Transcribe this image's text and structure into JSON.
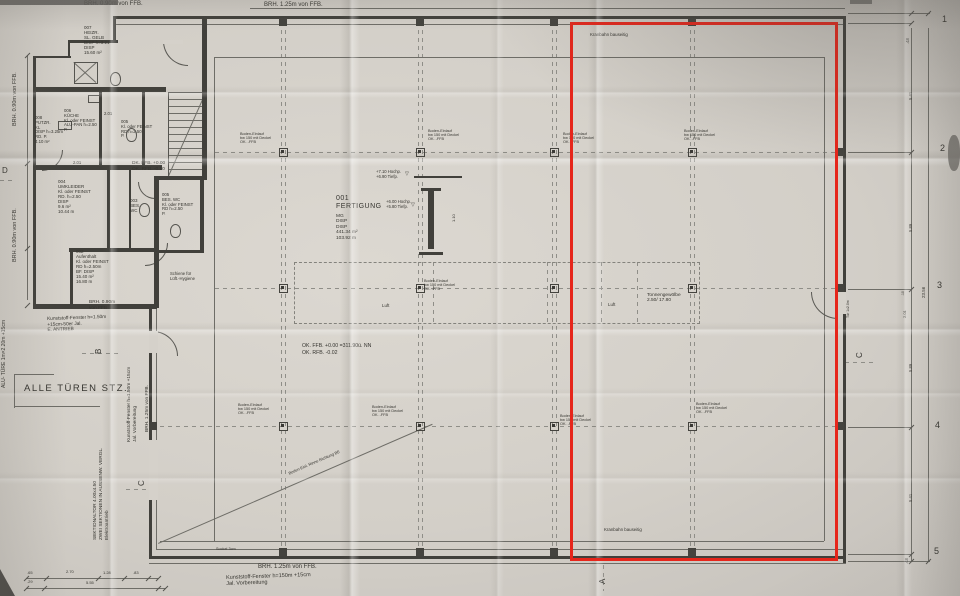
{
  "highlight": {
    "x": 570,
    "y": 22,
    "w": 268,
    "h": 539,
    "color": "#e6261b"
  },
  "plan": {
    "walls": [
      [
        113,
        16,
        733,
        3
      ],
      [
        843,
        16,
        3,
        547
      ],
      [
        149,
        556,
        697,
        3
      ],
      [
        149,
        306,
        3,
        253
      ],
      [
        113,
        16,
        3,
        27
      ],
      [
        69,
        40,
        49,
        3
      ],
      [
        33,
        56,
        3,
        252
      ],
      [
        33,
        56,
        38,
        2
      ],
      [
        68,
        40,
        2,
        18
      ],
      [
        33,
        304,
        124,
        5
      ],
      [
        36,
        87,
        130,
        5
      ],
      [
        99,
        92,
        3,
        76
      ],
      [
        142,
        92,
        3,
        76
      ],
      [
        36,
        165,
        126,
        5
      ],
      [
        202,
        18,
        5,
        162
      ],
      [
        157,
        176,
        50,
        4
      ],
      [
        154,
        176,
        5,
        76
      ],
      [
        107,
        170,
        3,
        82
      ],
      [
        129,
        170,
        2,
        82
      ],
      [
        69,
        248,
        88,
        4
      ],
      [
        70,
        248,
        3,
        60
      ],
      [
        200,
        176,
        4,
        76
      ],
      [
        157,
        250,
        47,
        3
      ],
      [
        154,
        252,
        5,
        56
      ],
      [
        414,
        176,
        48,
        2
      ],
      [
        421,
        188,
        20,
        3
      ],
      [
        428,
        191,
        6,
        58
      ],
      [
        419,
        252,
        24,
        3
      ]
    ],
    "thin": [
      [
        113,
        24,
        733,
        1
      ],
      [
        837,
        24,
        1,
        532
      ],
      [
        157,
        549,
        689,
        1
      ],
      [
        156,
        306,
        1,
        244
      ],
      [
        214,
        57,
        610,
        1
      ],
      [
        160,
        541,
        664,
        1
      ],
      [
        214,
        57,
        1,
        484
      ],
      [
        824,
        57,
        1,
        484
      ],
      [
        27,
        55,
        1,
        245
      ],
      [
        911,
        28,
        1,
        534
      ],
      [
        928,
        28,
        1,
        534
      ],
      [
        848,
        13,
        82,
        1
      ],
      [
        848,
        23,
        64,
        1
      ],
      [
        848,
        152,
        64,
        1
      ],
      [
        848,
        289,
        64,
        1
      ],
      [
        848,
        427,
        64,
        1
      ],
      [
        848,
        554,
        64,
        1
      ],
      [
        848,
        561,
        82,
        1
      ],
      [
        26,
        578,
        132,
        1
      ],
      [
        26,
        588,
        140,
        1
      ],
      [
        250,
        8,
        595,
        1
      ],
      [
        149,
        563,
        697,
        1
      ],
      [
        14,
        374,
        40,
        1
      ],
      [
        14,
        374,
        1,
        34
      ],
      [
        14,
        406,
        86,
        1
      ],
      [
        150,
        440,
        8,
        1
      ],
      [
        150,
        499,
        8,
        1
      ]
    ],
    "rot_lines": [
      [
        168,
        176,
        88,
        -66
      ],
      [
        158,
        543,
        299,
        -23.5
      ],
      [
        74,
        62,
        30,
        42
      ],
      [
        74,
        82,
        30,
        -42
      ]
    ],
    "dash_h": [
      [
        215,
        152,
        620
      ],
      [
        215,
        288,
        620
      ],
      [
        160,
        426,
        676
      ],
      [
        0,
        180,
        16
      ],
      [
        82,
        353,
        36
      ],
      [
        126,
        489,
        30
      ],
      [
        845,
        362,
        30
      ]
    ],
    "dash_v": [
      [
        281,
        30,
        516
      ],
      [
        285,
        30,
        516
      ],
      [
        418,
        30,
        516
      ],
      [
        422,
        30,
        516
      ],
      [
        552,
        30,
        516
      ],
      [
        556,
        30,
        516
      ],
      [
        690,
        30,
        516
      ],
      [
        694,
        30,
        516
      ],
      [
        433,
        262,
        60
      ],
      [
        547,
        262,
        60
      ],
      [
        601,
        262,
        60
      ],
      [
        637,
        262,
        60
      ],
      [
        603,
        565,
        26
      ]
    ],
    "zones": [
      [
        294,
        262,
        404,
        60
      ]
    ],
    "columns": [
      [
        283,
        152
      ],
      [
        420,
        152
      ],
      [
        554,
        152
      ],
      [
        692,
        152
      ],
      [
        283,
        288
      ],
      [
        420,
        288
      ],
      [
        554,
        288
      ],
      [
        692,
        288
      ],
      [
        283,
        426
      ],
      [
        420,
        426
      ],
      [
        554,
        426
      ],
      [
        692,
        426
      ]
    ],
    "pilasters": [
      [
        283,
        22
      ],
      [
        420,
        22
      ],
      [
        554,
        22
      ],
      [
        692,
        22
      ],
      [
        283,
        552
      ],
      [
        420,
        552
      ],
      [
        554,
        552
      ],
      [
        692,
        552
      ],
      [
        840,
        152
      ],
      [
        840,
        288
      ],
      [
        840,
        426
      ],
      [
        153,
        426
      ]
    ],
    "gaps": [
      [
        836,
        292,
        10,
        22
      ],
      [
        149,
        331,
        9,
        22
      ],
      [
        149,
        440,
        9,
        60
      ],
      [
        163,
        40,
        20,
        4
      ]
    ],
    "arcs": [
      [
        811,
        292,
        26,
        "bl"
      ],
      [
        153,
        331,
        24,
        "tr"
      ],
      [
        163,
        41,
        24,
        "bl"
      ],
      [
        42,
        150,
        20,
        "br"
      ],
      [
        138,
        182,
        16,
        "bl"
      ],
      [
        145,
        243,
        22,
        "br"
      ]
    ],
    "fixtures": [
      [
        110,
        72,
        9,
        12,
        "wc"
      ],
      [
        126,
        128,
        9,
        12,
        "wc"
      ],
      [
        139,
        203,
        9,
        12,
        "wc"
      ],
      [
        170,
        224,
        9,
        12,
        "wc"
      ],
      [
        58,
        121,
        12,
        7,
        "sink"
      ],
      [
        88,
        95,
        10,
        6,
        "sink"
      ],
      [
        74,
        62,
        22,
        20,
        "shower"
      ]
    ],
    "stairs": [
      168,
      92,
      35,
      84
    ],
    "ticks": [
      [
        23,
        578
      ],
      [
        43,
        578
      ],
      [
        95,
        578
      ],
      [
        121,
        578
      ],
      [
        145,
        578
      ],
      [
        155,
        578
      ],
      [
        23,
        588
      ],
      [
        41,
        588
      ],
      [
        155,
        588
      ],
      [
        162,
        588
      ],
      [
        24,
        55
      ],
      [
        24,
        163
      ],
      [
        24,
        248
      ],
      [
        24,
        305
      ],
      [
        908,
        13
      ],
      [
        908,
        23
      ],
      [
        908,
        152
      ],
      [
        908,
        289
      ],
      [
        908,
        427
      ],
      [
        908,
        554
      ],
      [
        908,
        561
      ],
      [
        925,
        13
      ],
      [
        925,
        561
      ]
    ]
  },
  "labels": [
    {
      "t": "BRH. 0.90m von FFB.",
      "x": 84,
      "y": 1,
      "fs": 6,
      "n": "note-brh-top-left"
    },
    {
      "t": "BRH. 1.25m von FFB.",
      "x": 264,
      "y": 2,
      "fs": 6,
      "n": "note-brh-top"
    },
    {
      "t": "BRH. 1.25m von FFB.",
      "x": 258,
      "y": 564,
      "fs": 6,
      "n": "note-brh-bottom"
    },
    {
      "t": "Kunststoff-Fenster h=150m +15cm\nJal. Vorbereitung",
      "x": 226,
      "y": 575,
      "fs": 5.5,
      "rot": -2,
      "n": "note-fenster-bottom"
    },
    {
      "t": "BRH. 0.90m von FFB.",
      "x": 12,
      "y": 126,
      "fs": 5.5,
      "rot": -90
    },
    {
      "t": "BRH. 0.90m von FFB.",
      "x": 12,
      "y": 262,
      "fs": 5.5,
      "rot": -90
    },
    {
      "t": "ALU- TÜRE 1m×2.20m +15cm",
      "x": 2,
      "y": 388,
      "fs": 5,
      "rot": -90,
      "n": "note-alu-tuere"
    },
    {
      "t": "SEKTIONALTOR 4.00x4.50\nZWEI SEKTIONEN IN AUSSENW. VERGL.\nElektroantrieb",
      "x": 93,
      "y": 540,
      "fs": 4.8,
      "rot": -90,
      "lh": 6,
      "n": "note-sektionaltor"
    },
    {
      "t": "Kunststoff-Fenster h=1.50m +15cm\nJal. Vorbereitung",
      "x": 127,
      "y": 442,
      "fs": 4.8,
      "rot": -90,
      "lh": 5.5
    },
    {
      "t": "BRH. 1.25m von FFB.",
      "x": 145,
      "y": 432,
      "fs": 4.8,
      "rot": -90
    },
    {
      "t": "ALLE TÜREN STZ.",
      "x": 24,
      "y": 384,
      "fs": 9.5,
      "ls": 1.5,
      "n": "note-alle-tueren"
    },
    {
      "t": "Kunststoff-Fenster h=1.50m\n+15cm-50er Jal.\nE. ANTRIEB",
      "x": 47,
      "y": 317,
      "fs": 4.8,
      "rot": -2,
      "lh": 5.5
    },
    {
      "t": "BRH. 0.90m\nvon FFB",
      "x": 89,
      "y": 300,
      "fs": 4.8,
      "lh": 5.5
    },
    {
      "t": "007\nHEIZR.\nSL. GELB\nDISP h=3.21\nDISP\n15.60 m²",
      "x": 84,
      "y": 25,
      "fs": 4.5,
      "lh": 5,
      "n": "room-label-heizraum"
    },
    {
      "t": "008\nPUTZR.\nKL\nDISP h=3.25m\nRD. P.\n4.10 m²",
      "x": 35,
      "y": 116,
      "fs": 4.3,
      "lh": 4.8,
      "n": "room-label-putzraum"
    },
    {
      "t": "006\nKÜCHE\nKl. oder FEINST\nALU-PAN h=2.50\nP.",
      "x": 64,
      "y": 109,
      "fs": 4.3,
      "lh": 4.8,
      "n": "room-label-kueche"
    },
    {
      "t": "005\nKl. oder FEINST\nRD h=2.50\nP.",
      "x": 121,
      "y": 120,
      "fs": 4.3,
      "lh": 4.8
    },
    {
      "t": "2.01",
      "x": 104,
      "y": 112,
      "fs": 4.2
    },
    {
      "t": "2.01",
      "x": 73,
      "y": 161,
      "fs": 4.2
    },
    {
      "t": "004\nUMKLEIDER\nKl. oder FEINST\nRD. h=2.50\nDISP\n9.6 m²\n10.44 m",
      "x": 58,
      "y": 179,
      "fs": 4.5,
      "lh": 5,
      "n": "room-label-umkleide"
    },
    {
      "t": "003\nBES.\nWC",
      "x": 130,
      "y": 198,
      "fs": 4.5,
      "lh": 5,
      "n": "room-label-wc"
    },
    {
      "t": "005\nBES. WC\nKl. oder FEINST\nRD h=2.50\nP.",
      "x": 162,
      "y": 193,
      "fs": 4.3,
      "lh": 4.8,
      "n": "room-label-bes-wc"
    },
    {
      "t": "DK. FFB. +0.00\nOK. RFB. -0.10",
      "x": 132,
      "y": 161,
      "fs": 4.8,
      "lh": 5.6,
      "n": "level-note-office"
    },
    {
      "t": "002\nAufenthalt\nKl. oder FEINST\nRD h=2.50m\nBF. DISP\n15.40 m²\n16.80 m",
      "x": 76,
      "y": 249,
      "fs": 4.5,
      "lh": 5,
      "n": "room-label-aufenthalt"
    },
    {
      "t": "Schiene für\nLüft.-Hygiene",
      "x": 170,
      "y": 272,
      "fs": 4.2,
      "lh": 4.6
    },
    {
      "t": "001\nFERTIGUNG",
      "x": 336,
      "y": 195,
      "fs": 7,
      "lh": 8,
      "ls": 0.5,
      "n": "room-label-fertigung"
    },
    {
      "t": "MG\nDISP\nDISP\n441.34 m²\n103.92 m",
      "x": 336,
      "y": 214,
      "fs": 4.8,
      "lh": 5.4
    },
    {
      "t": "+7.10 Hochp.\n+6.90 Tiefp.",
      "x": 376,
      "y": 170,
      "fs": 4.2,
      "lh": 4.8,
      "n": "crane-level-note"
    },
    {
      "t": "+6.00 Hochp.\n+5.80 Tiefp.",
      "x": 386,
      "y": 200,
      "fs": 4.2,
      "lh": 4.8,
      "n": "crane-level-note"
    },
    {
      "t": "▽",
      "x": 405,
      "y": 172,
      "fs": 5
    },
    {
      "t": "▽",
      "x": 411,
      "y": 203,
      "fs": 5
    },
    {
      "t": "1.10",
      "x": 452,
      "y": 222,
      "fs": 4,
      "rot": -90
    },
    {
      "t": "Boden-Einlauf\nbw 150 mit Deckel\nOK. -FFB",
      "x": 240,
      "y": 132,
      "fs": 3.8,
      "lh": 4.2,
      "n": "drain-label"
    },
    {
      "t": "Boden-Einlauf\nbw 150 mit Deckel\nOK. -FFB",
      "x": 428,
      "y": 129,
      "fs": 3.8,
      "lh": 4.2,
      "n": "drain-label"
    },
    {
      "t": "Boden-Einlauf\nbw 150 mit Deckel\nOK. -FFB",
      "x": 563,
      "y": 132,
      "fs": 3.8,
      "lh": 4.2,
      "n": "drain-label"
    },
    {
      "t": "Boden-Einlauf\nbw 150 mit Deckel\nOK. -FFB",
      "x": 684,
      "y": 129,
      "fs": 3.8,
      "lh": 4.2,
      "n": "drain-label"
    },
    {
      "t": "Boden-Einlauf\nbw 150 mit Deckel\nOK. -FFB",
      "x": 424,
      "y": 279,
      "fs": 3.8,
      "lh": 4.2,
      "n": "drain-label"
    },
    {
      "t": "Boden-Einlauf\nbw 150 mit Deckel\nOK. -FFB",
      "x": 238,
      "y": 403,
      "fs": 3.8,
      "lh": 4.2,
      "n": "drain-label"
    },
    {
      "t": "Boden-Einlauf\nbw 150 mit Deckel\nOK. -FFB",
      "x": 372,
      "y": 405,
      "fs": 3.8,
      "lh": 4.2,
      "n": "drain-label"
    },
    {
      "t": "Boden-Einlauf\nbw 150 mit Deckel\nOK. -FFB",
      "x": 560,
      "y": 414,
      "fs": 3.8,
      "lh": 4.2,
      "n": "drain-label"
    },
    {
      "t": "Boden-Einlauf\nbw 150 mit Deckel\nOK. -FFB",
      "x": 696,
      "y": 402,
      "fs": 3.8,
      "lh": 4.2,
      "n": "drain-label"
    },
    {
      "t": "Kranbahn bauseitig",
      "x": 590,
      "y": 32,
      "fs": 4.4,
      "n": "crane-note"
    },
    {
      "t": "Kranbahn bauseitig",
      "x": 604,
      "y": 527,
      "fs": 4.4,
      "n": "crane-note"
    },
    {
      "t": "Tonnengewölbe\n2.50/ 17.80",
      "x": 647,
      "y": 293,
      "fs": 4.8,
      "lh": 5.4,
      "n": "vault-label"
    },
    {
      "t": "Luft",
      "x": 382,
      "y": 303,
      "fs": 4.4
    },
    {
      "t": "Luft",
      "x": 608,
      "y": 302,
      "fs": 4.4
    },
    {
      "t": "OK. FFB. +0.00 =311.90ü. NN\nOK. RFB. -0.02",
      "x": 302,
      "y": 343,
      "fs": 5.2,
      "lh": 6.5,
      "n": "floor-level-note"
    },
    {
      "t": "Boden-Einl. Rinne Richtung BE",
      "x": 288,
      "y": 472,
      "fs": 4,
      "rot": -23.5,
      "n": "drain-channel-note"
    },
    {
      "t": "Sockel 3cm",
      "x": 216,
      "y": 547,
      "fs": 3.8
    },
    {
      "t": "Tür 1x2.0m",
      "x": 846,
      "y": 318,
      "fs": 3.5,
      "rot": -90
    },
    {
      "t": "2.01",
      "x": 903,
      "y": 318,
      "fs": 4,
      "rot": -90
    },
    {
      "t": ".10",
      "x": 901,
      "y": 296,
      "fs": 3.5,
      "rot": -90
    },
    {
      "t": ".48",
      "x": 906,
      "y": 44,
      "fs": 4.2,
      "rot": -90
    },
    {
      "t": "5.41",
      "x": 909,
      "y": 100,
      "fs": 4.2,
      "rot": -90
    },
    {
      "t": "5.89",
      "x": 909,
      "y": 232,
      "fs": 4.2,
      "rot": -90
    },
    {
      "t": "23.56",
      "x": 921,
      "y": 298,
      "fs": 4.5,
      "rot": -90
    },
    {
      "t": "5.89",
      "x": 909,
      "y": 372,
      "fs": 4.2,
      "rot": -90
    },
    {
      "t": "5.41",
      "x": 909,
      "y": 502,
      "fs": 4.2,
      "rot": -90
    },
    {
      "t": ".48",
      "x": 905,
      "y": 564,
      "fs": 4.2,
      "rot": -90
    },
    {
      "t": "1",
      "x": 942,
      "y": 14,
      "fs": 9,
      "n": "grid-number"
    },
    {
      "t": "2",
      "x": 940,
      "y": 143,
      "fs": 9,
      "n": "grid-number"
    },
    {
      "t": "3",
      "x": 937,
      "y": 280,
      "fs": 9,
      "n": "grid-number"
    },
    {
      "t": "4",
      "x": 935,
      "y": 420,
      "fs": 9,
      "n": "grid-number"
    },
    {
      "t": "5",
      "x": 934,
      "y": 546,
      "fs": 9,
      "n": "grid-number"
    },
    {
      "t": "A",
      "x": 598,
      "y": 584,
      "fs": 8,
      "rot": -90,
      "n": "section-marker-a"
    },
    {
      "t": "B",
      "x": 94,
      "y": 354,
      "fs": 8,
      "rot": -90,
      "n": "section-marker-b"
    },
    {
      "t": "C",
      "x": 137,
      "y": 486,
      "fs": 8,
      "rot": -90,
      "n": "section-marker-c"
    },
    {
      "t": "C",
      "x": 855,
      "y": 358,
      "fs": 8,
      "rot": -90,
      "n": "section-marker-c"
    },
    {
      "t": "D",
      "x": 2,
      "y": 166,
      "fs": 8,
      "n": "section-marker-d"
    },
    {
      "t": ".65",
      "x": 27,
      "y": 571,
      "fs": 4,
      "n": "dim-label"
    },
    {
      "t": "2.70",
      "x": 66,
      "y": 570,
      "fs": 4,
      "n": "dim-label"
    },
    {
      "t": "1.28",
      "x": 103,
      "y": 571,
      "fs": 4,
      "n": "dim-label"
    },
    {
      "t": ".83",
      "x": 133,
      "y": 571,
      "fs": 4,
      "n": "dim-label"
    },
    {
      "t": ".29",
      "x": 27,
      "y": 580,
      "fs": 4,
      "n": "dim-label"
    },
    {
      "t": "5.55",
      "x": 86,
      "y": 581,
      "fs": 4,
      "n": "dim-label"
    }
  ]
}
